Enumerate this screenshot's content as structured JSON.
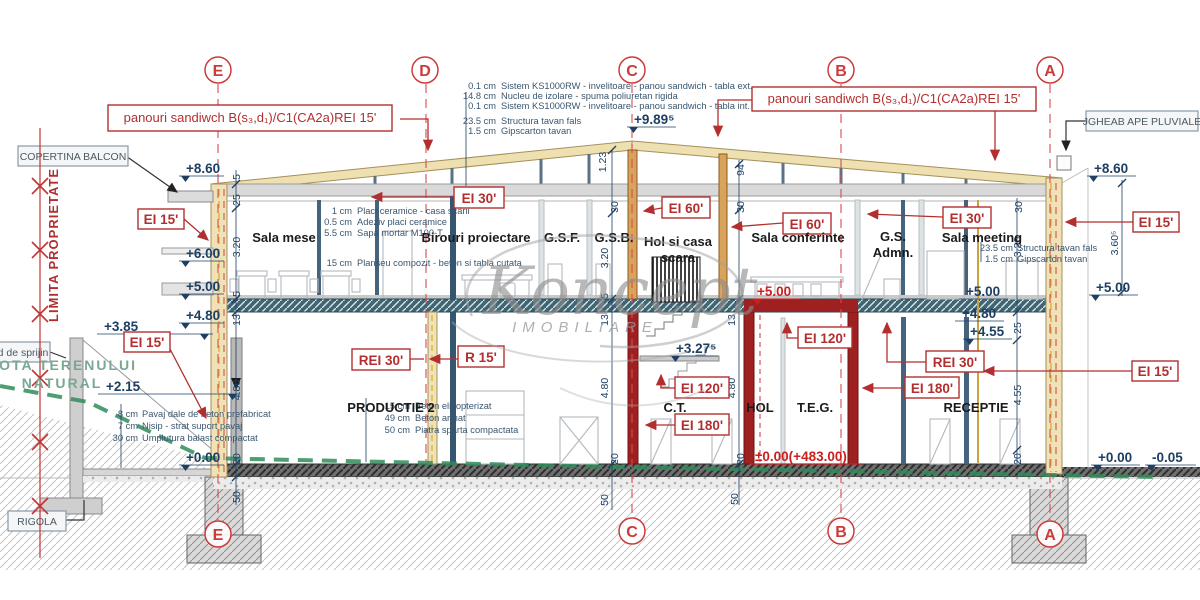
{
  "watermark": {
    "brand": "Koncept",
    "subtitle": "IMOBILIARE"
  },
  "axis_letters": {
    "e": "E",
    "d": "D",
    "c": "C",
    "b": "B",
    "a": "A"
  },
  "callouts": {
    "panouri_left": "panouri sandiwch B(s₃,d₁)/C1(CA2a)REI 15'",
    "panouri_right": "panouri sandiwch B(s₃,d₁)/C1(CA2a)REI 15'",
    "copertina": "COPERTINA BALCON",
    "jgheab": "JGHEAB APE PLUVIALE",
    "zid_sprijin": "d de sprijin",
    "rigola": "RIGOLA",
    "limita_proprietate": "LIMITA PROPRIETATE",
    "cota_teren_line1": "COTA TERENULUI",
    "cota_teren_line2": "NATURAL"
  },
  "fire_ratings": {
    "left_upper": "EI 15'",
    "left_lower": "EI 15'",
    "ceiling_left": "EI 30'",
    "wall_c": "EI 60'",
    "wall_hol": "EI 60'",
    "ceiling_right": "EI 30'",
    "slab_left": "REI 30'",
    "wall_d": "R 15'",
    "teg_top": "EI 120'",
    "ct_upper": "EI 120'",
    "ct_lower": "EI 180'",
    "slab_right": "REI 30'",
    "teg_wall": "EI 180'",
    "right_upper": "EI 15'",
    "right_lower": "EI 15'"
  },
  "rooms": {
    "sala_mese": "Sala mese",
    "birouri": "Birouri proiectare",
    "gsf": "G.S.F.",
    "gsb": "G.S.B.",
    "hol_casa_1": "Hol si casa",
    "hol_casa_2": "scara",
    "sala_conferinte": "Sala conferinte",
    "gs_admn_1": "G.S.",
    "gs_admn_2": "Admn.",
    "sala_meeting": "Sala meeting",
    "productie": "PRODUCTIE 2",
    "ct": "C.T.",
    "hol": "HOL",
    "teg": "T.E.G.",
    "receptie": "RECEPTIE"
  },
  "elevations": {
    "left_860": "+8.60",
    "left_600": "+6.00",
    "left_500": "+5.00",
    "left_480": "+4.80",
    "left_385": "+3.85",
    "left_215": "+2.15",
    "left_000": "+0.00",
    "ridge": "+9.89⁵",
    "stair": "+3.27⁵",
    "teg_500": "+5.00",
    "right_in_500": "+5.00",
    "right_in_480": "+4.80",
    "right_in_455": "+4.55",
    "right_out_860": "+8.60",
    "right_out_500": "+5.00",
    "right_out_000": "+0.00",
    "right_out_minus": "-0.05",
    "ground_abs": "±0.00(+483.00)"
  },
  "dims": {
    "v5": "5",
    "v13": "13",
    "v20": "20",
    "v25": "25",
    "v30": "30",
    "v50": "50",
    "v94": "94",
    "v1_23": "1.23",
    "v3_20": "3.20",
    "v4_55": "4.55",
    "v4_80": "4.80",
    "v3_60": "3.60⁵"
  },
  "layers": {
    "roof": [
      {
        "size": "0.1 cm",
        "desc": "Sistem KS1000RW - invelitoare - panou sandwich - tabla ext."
      },
      {
        "size": "14.8 cm",
        "desc": "Nucleu de izolare - spuma poliuretan rigida"
      },
      {
        "size": "0.1 cm",
        "desc": "Sistem KS1000RW - invelitoare - panou sandwich - tabla int."
      },
      {
        "size": "23.5 cm",
        "desc": "Structura tavan fals"
      },
      {
        "size": "1.5 cm",
        "desc": "Gipscarton tavan"
      }
    ],
    "floor1": [
      {
        "size": "1 cm",
        "desc": "Placi ceramice - casa scarii"
      },
      {
        "size": "0.5 cm",
        "desc": "Adeziv placi ceramice"
      },
      {
        "size": "5.5 cm",
        "desc": "Sapa mortar M100-T"
      },
      {
        "size": "15 cm",
        "desc": "Planseu compozit - beton si tabla cutata"
      }
    ],
    "ceiling_right": [
      {
        "size": "23.5 cm",
        "desc": "Structura tavan fals"
      },
      {
        "size": "1.5 cm",
        "desc": "Gipscarton tavan"
      }
    ],
    "exterior": [
      {
        "size": "8 cm",
        "desc": "Pavaj dale de beton prefabricat"
      },
      {
        "size": "7 cm",
        "desc": "Nisip - strat suport pavaj"
      },
      {
        "size": "30 cm",
        "desc": "Umplutura balast compactat"
      }
    ],
    "ground": [
      {
        "size": "15 cm",
        "desc": "Beton elicopterizat"
      },
      {
        "size": "49 cm",
        "desc": "Beton armat"
      },
      {
        "size": "50 cm",
        "desc": "Piatra sparta compactata"
      }
    ]
  }
}
